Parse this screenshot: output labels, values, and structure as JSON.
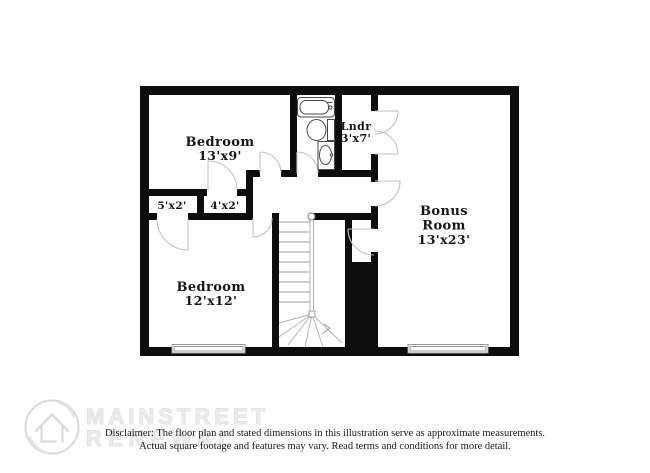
{
  "rooms": {
    "bedroom_top": {
      "name": "Bedroom",
      "dims": "13'x9'"
    },
    "laundry": {
      "name": "Lndr",
      "dims": "3'x7'"
    },
    "bonus": {
      "name_line1": "Bonus",
      "name_line2": "Room",
      "dims": "13'x23'"
    },
    "closet_left": {
      "dims": "5'x2'"
    },
    "closet_right": {
      "dims": "4'x2'"
    },
    "bedroom_bottom": {
      "name": "Bedroom",
      "dims": "12'x12'"
    }
  },
  "watermark": {
    "brand_line1": "MAINSTREET",
    "brand_line2": "RENEWAL",
    "logo_icon": "mainstreet-house-circle-logo"
  },
  "disclaimer": {
    "line1": "Disclaimer: The floor plan and stated dimensions in this illustration serve as approximate measurements.",
    "line2": "Actual square footage and features may vary. Read terms and conditions for more detail."
  },
  "colors": {
    "wall": "#0d0d0d",
    "door_arc": "#c2c2c2",
    "stair_line": "#b3b3b3",
    "fixture_line": "#4a4a4a",
    "label_text": "#161616",
    "watermark_gray": "#ececec",
    "window_line": "#9a9a9a"
  }
}
